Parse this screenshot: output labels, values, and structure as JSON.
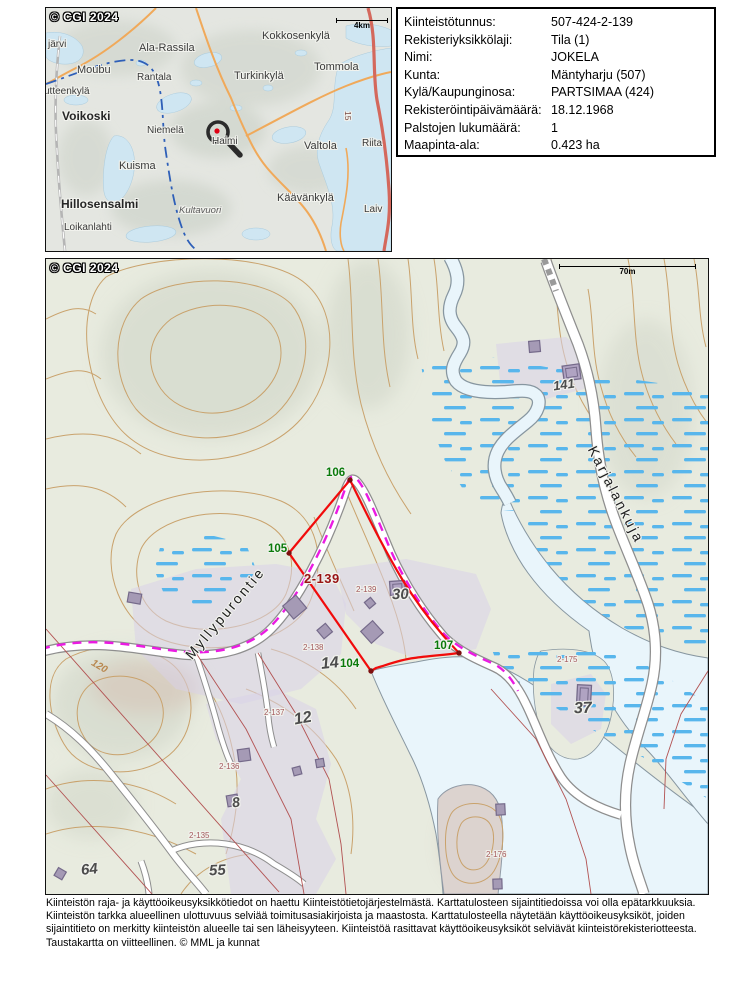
{
  "overview": {
    "copyright": "© CGI 2024",
    "scalebar": "4km",
    "labels": [
      {
        "text": "järvi",
        "x": 2,
        "y": 31,
        "cls": "ov-place"
      },
      {
        "text": "Ala-Rassila",
        "x": 93,
        "y": 34,
        "cls": "ov-place-lg"
      },
      {
        "text": "Kokkosenkylä",
        "x": 216,
        "y": 22,
        "cls": "ov-place-lg"
      },
      {
        "text": "Moubu",
        "x": 31,
        "y": 56,
        "cls": "ov-place-lg"
      },
      {
        "text": "Rantala",
        "x": 91,
        "y": 64,
        "cls": "ov-place"
      },
      {
        "text": "Turkinkylä",
        "x": 188,
        "y": 62,
        "cls": "ov-place-lg"
      },
      {
        "text": "Tommola",
        "x": 268,
        "y": 53,
        "cls": "ov-place-lg"
      },
      {
        "text": "utteenkylä",
        "x": -2,
        "y": 78,
        "cls": "ov-place"
      },
      {
        "text": "Voikoski",
        "x": 16,
        "y": 101,
        "cls": "ov-town"
      },
      {
        "text": "Niemelä",
        "x": 101,
        "y": 117,
        "cls": "ov-place"
      },
      {
        "text": "Haimi",
        "x": 166,
        "y": 128,
        "cls": "ov-place"
      },
      {
        "text": "Kuisma",
        "x": 73,
        "y": 152,
        "cls": "ov-place-lg"
      },
      {
        "text": "Valtola",
        "x": 258,
        "y": 132,
        "cls": "ov-place-lg"
      },
      {
        "text": "Hillosensalmi",
        "x": 15,
        "y": 189,
        "cls": "ov-town"
      },
      {
        "text": "Kultavuori",
        "x": 133,
        "y": 197,
        "cls": "ov-nature"
      },
      {
        "text": "Käävänkylä",
        "x": 231,
        "y": 184,
        "cls": "ov-place-lg"
      },
      {
        "text": "Loikanlahti",
        "x": 18,
        "y": 214,
        "cls": "ov-place"
      },
      {
        "text": "Riita",
        "x": 316,
        "y": 130,
        "cls": "ov-place"
      },
      {
        "text": "Laiv",
        "x": 318,
        "y": 196,
        "cls": "ov-place"
      },
      {
        "text": "15",
        "x": 307,
        "y": 103,
        "cls": "ov-roadnum",
        "rot": 90
      }
    ]
  },
  "info_panel": {
    "rows": [
      {
        "label": "Kiinteistötunnus:",
        "value": "507-424-2-139"
      },
      {
        "label": "Rekisteriyksikkölaji:",
        "value": "Tila (1)"
      },
      {
        "label": "Nimi:",
        "value": "JOKELA"
      },
      {
        "label": "Kunta:",
        "value": "Mäntyharju (507)"
      },
      {
        "label": "Kylä/Kaupunginosa:",
        "value": "PARTSIMAA (424)"
      },
      {
        "label": "Rekisteröintipäivämäärä:",
        "value": "18.12.1968"
      },
      {
        "label": "Palstojen lukumäärä:",
        "value": "1"
      },
      {
        "label": "Maapinta-ala:",
        "value": "0.423 ha"
      }
    ]
  },
  "main_map": {
    "copyright": "© CGI 2024",
    "scalebar": "70m",
    "labels": [
      {
        "text": "105",
        "x": 222,
        "y": 284,
        "cls": "mm-vertex"
      },
      {
        "text": "106",
        "x": 280,
        "y": 208,
        "cls": "mm-vertex"
      },
      {
        "text": "104",
        "x": 294,
        "y": 399,
        "cls": "mm-vertex"
      },
      {
        "text": "107",
        "x": 388,
        "y": 381,
        "cls": "mm-vertex"
      },
      {
        "text": "2-139",
        "x": 258,
        "y": 312,
        "cls": "mm-target"
      },
      {
        "text": "2-139",
        "x": 310,
        "y": 326,
        "cls": "mm-pid"
      },
      {
        "text": "2-138",
        "x": 257,
        "y": 384,
        "cls": "mm-pid"
      },
      {
        "text": "2-137",
        "x": 218,
        "y": 449,
        "cls": "mm-pid"
      },
      {
        "text": "2-136",
        "x": 173,
        "y": 503,
        "cls": "mm-pid"
      },
      {
        "text": "2-135",
        "x": 143,
        "y": 572,
        "cls": "mm-pid"
      },
      {
        "text": "2-175",
        "x": 511,
        "y": 396,
        "cls": "mm-pid"
      },
      {
        "text": "2-176",
        "x": 440,
        "y": 591,
        "cls": "mm-pid"
      },
      {
        "text": "141",
        "x": 507,
        "y": 118,
        "cls": "mm-num",
        "rot": -8,
        "fs": 13
      },
      {
        "text": "30",
        "x": 346,
        "y": 327,
        "cls": "mm-num",
        "rot": -2
      },
      {
        "text": "14",
        "x": 275,
        "y": 396,
        "cls": "mm-num",
        "rot": -6,
        "fs": 16
      },
      {
        "text": "12",
        "x": 248,
        "y": 451,
        "cls": "mm-num",
        "rot": -10,
        "fs": 16
      },
      {
        "text": "8",
        "x": 186,
        "y": 535,
        "cls": "mm-num",
        "rot": -8,
        "fs": 14
      },
      {
        "text": "55",
        "x": 163,
        "y": 603,
        "cls": "mm-num",
        "rot": -3
      },
      {
        "text": "64",
        "x": 35,
        "y": 602,
        "cls": "mm-num",
        "rot": -6
      },
      {
        "text": "37",
        "x": 528,
        "y": 441,
        "cls": "mm-num",
        "rot": -2,
        "fs": 16
      },
      {
        "text": "Myllypurontie",
        "x": 142,
        "y": 390,
        "cls": "mm-road",
        "rot": -50
      },
      {
        "text": "Karjalankuja",
        "x": 546,
        "y": 180,
        "cls": "mm-road",
        "rot": 63
      },
      {
        "text": "120",
        "x": 46,
        "y": 398,
        "cls": "mm-contour",
        "rot": 30
      }
    ]
  },
  "footer": {
    "lines": [
      {
        "text": "Kiinteistön raja- ja käyttöoikeusyksikkötiedot on haettu Kiinteistötietojärjestelmästä. Karttatulosteen sijaintitiedoissa voi olla epätarkkuuksia."
      },
      {
        "text": "Kiinteistön tarkka alueellinen ulottuvuus selviää toimitusasiakirjoista ja maastosta. Karttatulosteella näytetään käyttöoikeusyksiköt, joiden"
      },
      {
        "text": "sijaintitieto on merkitty kiinteistön alueelle tai sen läheisyyteen. Kiinteistöä rasittavat käyttöoikeusyksiköt selviävät kiinteistörekisteriotteesta."
      },
      {
        "text": "Taustakartta on viitteellinen. © MML ja kunnat"
      }
    ]
  },
  "colors": {
    "boundary_red": "#f10b0b",
    "vertex_green": "#0a7a0a",
    "target_label_red": "#991414",
    "easement_magenta": "#ea1be2",
    "wetland_blue": "#58b6ec",
    "contour_tan": "#c9a26c",
    "water_fill": "#e9f5fb",
    "building_purple": "#a59ab5",
    "zone_lavender": "#d8d1e8"
  }
}
